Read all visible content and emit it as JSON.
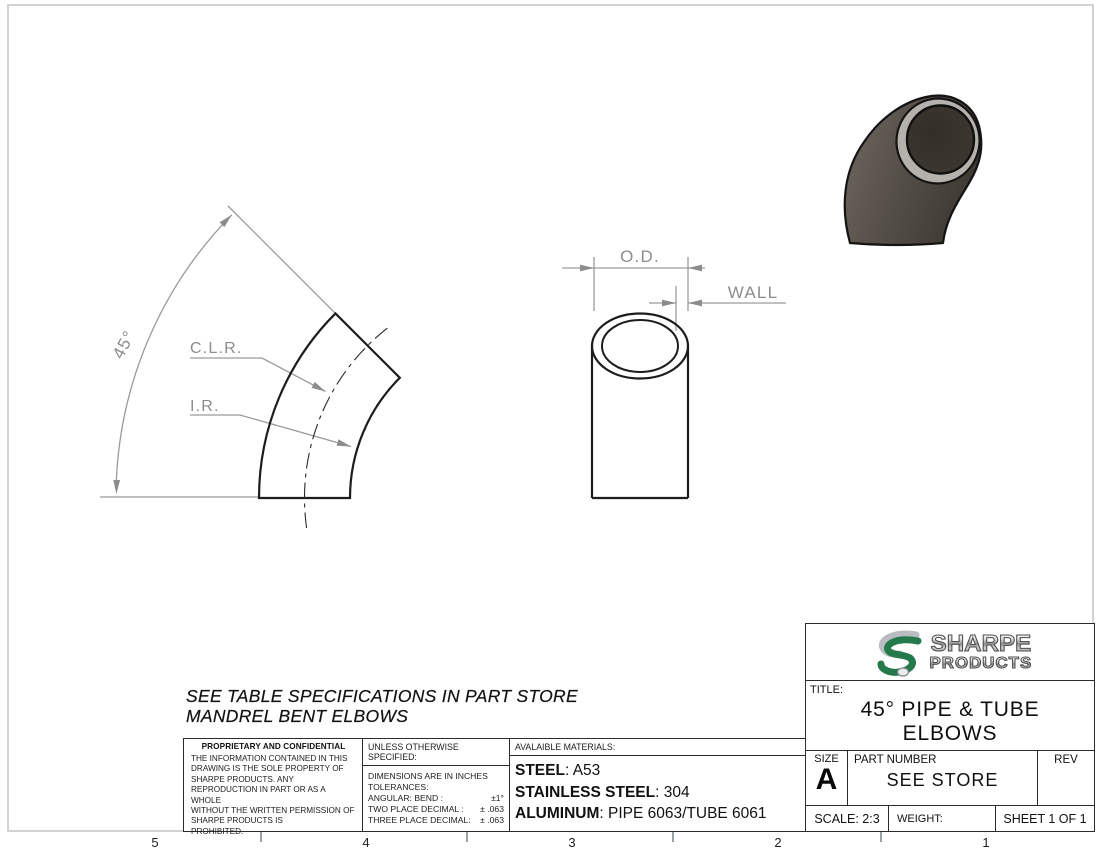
{
  "colors": {
    "logo_green": "#257a4c",
    "logo_silver": "#b9bdc1",
    "annotation_gray": "#8c8c8c",
    "line_dark": "#2b2b2b",
    "elbow_body_light": "#6e6860",
    "elbow_body_dark": "#3e3933",
    "elbow_ring": "#b5b2ad"
  },
  "zones": {
    "numbers": [
      "5",
      "4",
      "3",
      "2",
      "1"
    ]
  },
  "views": {
    "profile": {
      "angle": "45°",
      "clr": "C.L.R.",
      "ir": "I.R."
    },
    "end": {
      "od": "O.D.",
      "wall": "WALL"
    }
  },
  "note": {
    "line1": "SEE TABLE SPECIFICATIONS IN PART STORE",
    "line2": "MANDREL BENT ELBOWS"
  },
  "proprietary": {
    "header": "PROPRIETARY AND CONFIDENTIAL",
    "lines": [
      "THE INFORMATION CONTAINED IN THIS",
      "DRAWING IS THE SOLE PROPERTY OF",
      "SHARPE PRODUCTS.  ANY",
      "REPRODUCTION IN PART OR AS A WHOLE",
      "WITHOUT THE WRITTEN PERMISSION OF",
      "SHARPE PRODUCTS IS",
      "PROHIBITED."
    ]
  },
  "tolerances": {
    "header": "UNLESS OTHERWISE SPECIFIED:",
    "line1": "DIMENSIONS ARE IN INCHES",
    "line2": "TOLERANCES:",
    "rows": [
      {
        "label": "ANGULAR: BEND :",
        "value": "±1°"
      },
      {
        "label": "TWO PLACE DECIMAL  :",
        "value": "± .063"
      },
      {
        "label": "THREE PLACE DECIMAL:",
        "value": "± .063"
      }
    ]
  },
  "materials": {
    "header": "AVALAIBLE MATERIALS:",
    "rows": [
      {
        "label": "STEEL",
        "value": ": A53"
      },
      {
        "label": "STAINLESS STEEL",
        "value": ": 304"
      },
      {
        "label": "ALUMINUM",
        "value": ": PIPE 6063/TUBE 6061"
      }
    ]
  },
  "title_block": {
    "logo_line1": "SHARPE",
    "logo_line2": "PRODUCTS",
    "title_label": "TITLE:",
    "title_line1": "45° PIPE & TUBE",
    "title_line2": "ELBOWS",
    "size_label": "SIZE",
    "size_value": "A",
    "part_number_label": "PART NUMBER",
    "part_number_value": "SEE STORE",
    "rev_label": "REV",
    "scale": "SCALE: 2:3",
    "weight_label": "WEIGHT:",
    "sheet": "SHEET 1 OF 1"
  }
}
